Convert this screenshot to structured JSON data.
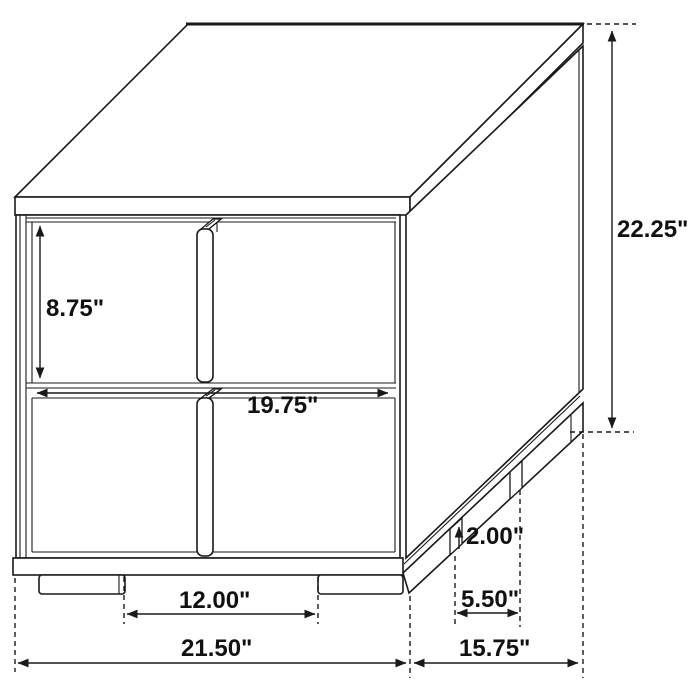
{
  "dimensions": {
    "overall_height": "22.25\"",
    "drawer_height": "8.75\"",
    "drawer_width": "19.75\"",
    "leg_height": "2.00\"",
    "side_leg_spacing": "5.50\"",
    "front_leg_spacing": "12.00\"",
    "overall_width": "21.50\"",
    "overall_depth": "15.75\""
  },
  "colors": {
    "line": "#1a1a1a",
    "label": "#111111",
    "background": "#ffffff"
  }
}
